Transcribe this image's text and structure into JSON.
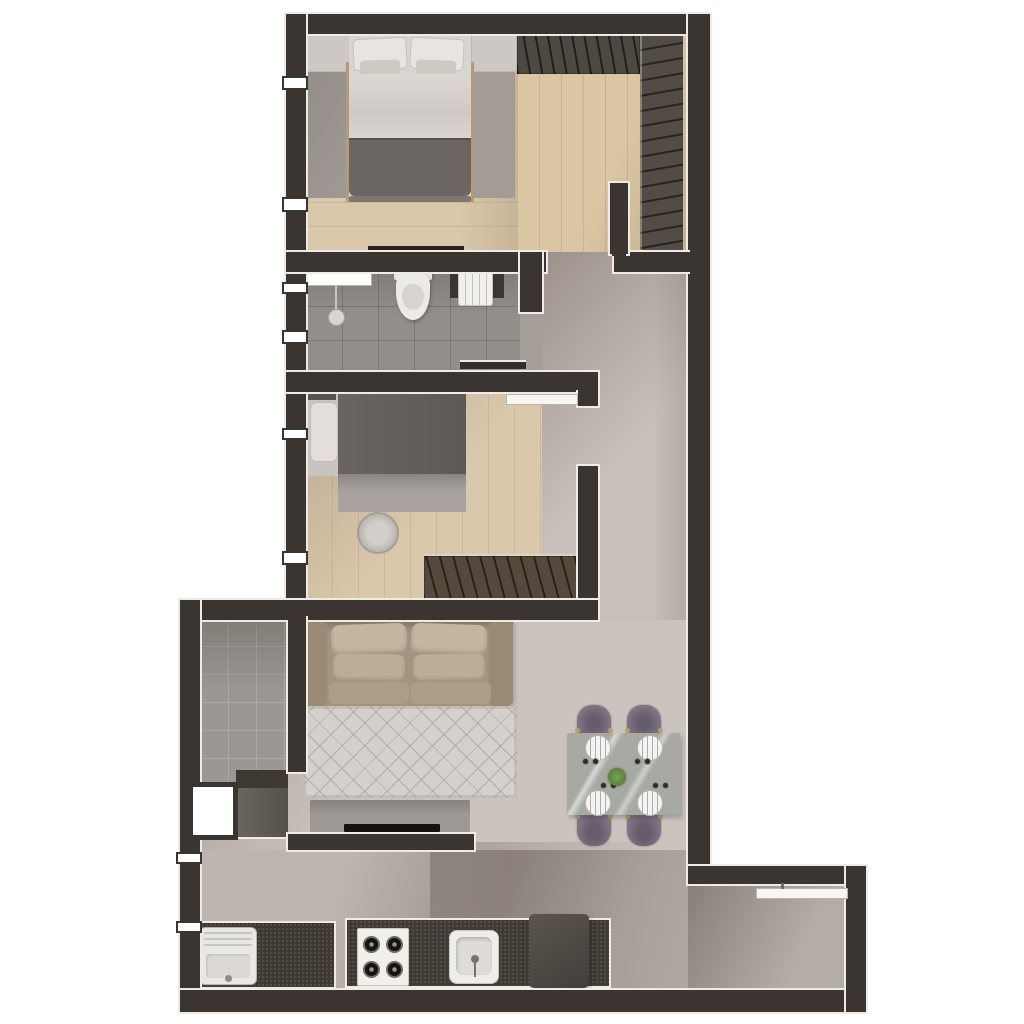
{
  "image": {
    "kind": "apartment floor plan",
    "style": "3D rendered top-down view",
    "background_color": "#ffffff",
    "text_labels": "none visible"
  },
  "palette": {
    "wall": "#3a3531",
    "wall_trim": "#eeebe7",
    "wood_floor": "#d9c8ab",
    "closet_wood_floor": "#dbc7a4",
    "tile_floor": "#938e89",
    "screed_floor": "#c7c0ba",
    "wardrobe_brown": "#4e4843",
    "sofa_beige": "#a2947f",
    "rug_living": "#d4d1cd",
    "rug_bedroom": "#a39c96",
    "chair_purple": "#847788",
    "table_marble": "#a7a9a3",
    "counter_dark": "#3f3933",
    "blanket_dark": "#6b6661",
    "plant_green": "#5e8f46"
  },
  "rooms": [
    {
      "name": "master-bedroom",
      "position": "top-left",
      "floor": "light wood planks",
      "furniture": [
        "double-bed with 2 pillows, light duvet and dark gray foot blanket",
        "nightstand-left",
        "nightstand-right",
        "gray area rug",
        "low wall shelf"
      ],
      "windows": 2
    },
    {
      "name": "walk-in-closet",
      "position": "top-right",
      "floor": "light wood planks",
      "furniture": [
        "hatched wardrobe along top wall",
        "hatched wardrobe along right wall"
      ]
    },
    {
      "name": "bathroom",
      "position": "middle-left",
      "floor": "gray ceramic tile",
      "furniture": [
        "shower glass screen",
        "hanging shower head",
        "toilet",
        "dark vanity with white basin",
        "dark bath mat"
      ],
      "windows": 2,
      "door": "opening to hallway on right"
    },
    {
      "name": "bedroom-2",
      "position": "middle",
      "floor": "light wood planks",
      "furniture": [
        "single bed with white pillow and dark blanket",
        "desk",
        "round stool",
        "hatched wardrobe bottom-right"
      ],
      "windows": 2,
      "door": "swing door open against top wall"
    },
    {
      "name": "hallway",
      "position": "middle-right",
      "floor": "gray screed with cast shadows"
    },
    {
      "name": "living-room",
      "position": "lower-middle",
      "floor": "gray screed",
      "furniture": [
        "two-seat beige sofa with 4 cushions",
        "diamond-pattern rug",
        "tv-stand",
        "flat tv"
      ]
    },
    {
      "name": "dining-area",
      "position": "lower-right of living room",
      "furniture": [
        "marble dining table",
        "4 purple upholstered chairs",
        "4 place settings with plates",
        "center plant",
        "8 small cups"
      ]
    },
    {
      "name": "service-laundry-room",
      "position": "lower-left",
      "floor": "gray tile",
      "furniture": [
        "dark counter with cabinet",
        "white service door"
      ]
    },
    {
      "name": "kitchen",
      "position": "bottom strip",
      "furniture": [
        "laundry counter with white utility tank",
        "main dark counter",
        "4-burner stove",
        "kitchen sink",
        "refrigerator"
      ]
    },
    {
      "name": "balcony",
      "position": "bottom-right extension",
      "floor": "gray gradient",
      "features": [
        "sliding glass door with handle"
      ]
    }
  ],
  "counts": {
    "bedrooms": 2,
    "bathrooms": 1,
    "dining_chairs": 4,
    "stove_burners": 4,
    "plates": 4,
    "windows_left_wall": 6
  }
}
